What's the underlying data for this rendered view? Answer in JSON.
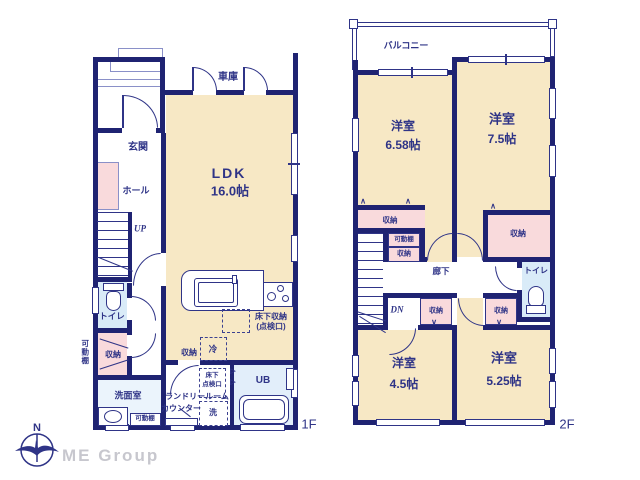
{
  "colors": {
    "wall": "#1f2372",
    "ink": "#2f3487",
    "cream": "#f7e8c5",
    "pink": "#f9dadc",
    "blue": "#d9ebf8",
    "bluelight": "#ebf4fc",
    "ubblue": "#e2eefa",
    "gray": "#c7c7ce"
  },
  "logo": {
    "brand": "ME Group",
    "compass_north": "N"
  },
  "floor1": {
    "tag": "1F",
    "garage": "車庫",
    "ldk_name": "LDK",
    "ldk_size": "16.0帖",
    "genkan": "玄関",
    "hall": "ホール",
    "stairs_up": "UP",
    "toilet": "トイレ",
    "movable_shelf_side": "可動棚",
    "storage_left": "収納",
    "washroom": "洗面室",
    "movable_shelf_bottom": "可動棚",
    "laundry_room": "ランドリールーム",
    "counter": "カウンター",
    "washer": "洗",
    "unit_bath": "UB",
    "fridge": "冷",
    "storage_kitchen": "収納",
    "underfloor_storage_line1": "床下収納",
    "underfloor_storage_line2": "(点検口)",
    "underfloor_check_line1": "床下",
    "underfloor_check_line2": "点検口"
  },
  "floor2": {
    "tag": "2F",
    "balcony": "バルコニー",
    "room_nw_name": "洋室",
    "room_nw_size": "6.58帖",
    "room_ne_name": "洋室",
    "room_ne_size": "7.5帖",
    "room_sw_name": "洋室",
    "room_sw_size": "4.5帖",
    "room_se_name": "洋室",
    "room_se_size": "5.25帖",
    "corridor": "廊下",
    "toilet": "トイレ",
    "stairs_down": "DN",
    "storage_nw": "収納",
    "movable_shelf": "可動棚",
    "storage_mid": "収納",
    "storage_ne": "収納",
    "storage_sw": "収納",
    "storage_se": "収納"
  }
}
